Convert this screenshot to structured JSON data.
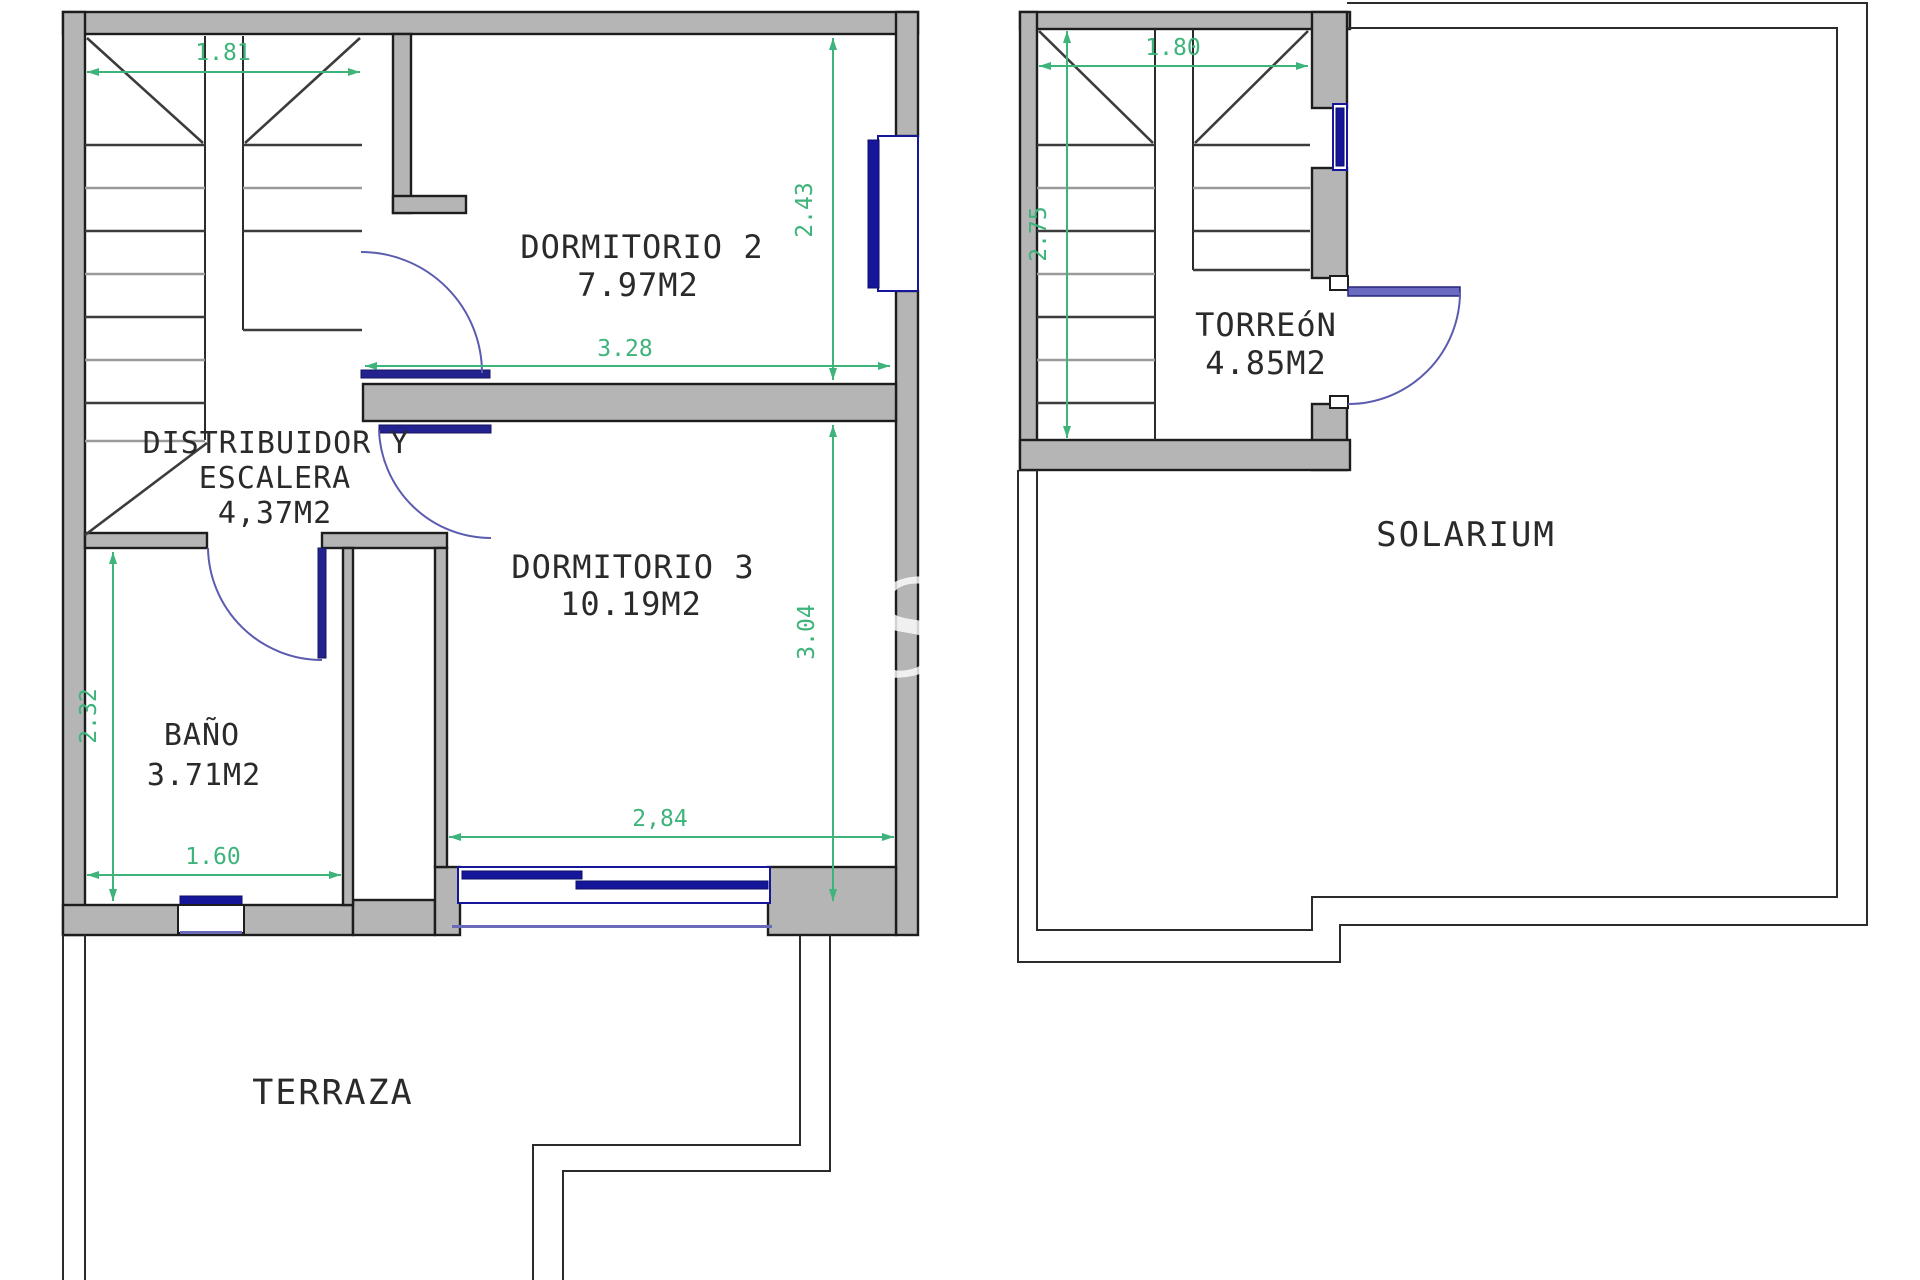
{
  "document": {
    "type": "floor-plan",
    "sheet": "upper floor and solarium plan"
  },
  "floor1": {
    "rooms": {
      "dormitorio2": {
        "name": "DORMITORIO 2",
        "area": "7.97M2"
      },
      "distribuidor": {
        "line1": "DISTRIBUIDOR Y",
        "line2": "ESCALERA",
        "area": "4,37M2"
      },
      "dormitorio3": {
        "name": "DORMITORIO 3",
        "area": "10.19M2"
      },
      "bano": {
        "name": "BAÑO",
        "area": "3.71M2"
      },
      "terraza": {
        "name": "TERRAZA"
      }
    },
    "dims": {
      "stair_width": "1.81",
      "dorm2_height": "2.43",
      "dorm2_width": "3.28",
      "dorm3_height": "3.04",
      "dorm3_width": "2,84",
      "bano_width": "1.60",
      "bano_height": "2.32"
    }
  },
  "floor2": {
    "rooms": {
      "torreon": {
        "name": "TORREóN",
        "area": "4.85M2"
      },
      "solarium": {
        "name": "SOLARIUM"
      }
    },
    "dims": {
      "torreon_width": "1.80",
      "torreon_height": "2.75"
    }
  },
  "colors": {
    "wall_fill": "#b5b5b5",
    "line_black": "#1d1d1d",
    "dimension_green": "#3eb37a",
    "window_blue": "#16169a",
    "door_arc_blue": "#5b5bb0"
  },
  "watermark": {
    "text": "S"
  }
}
